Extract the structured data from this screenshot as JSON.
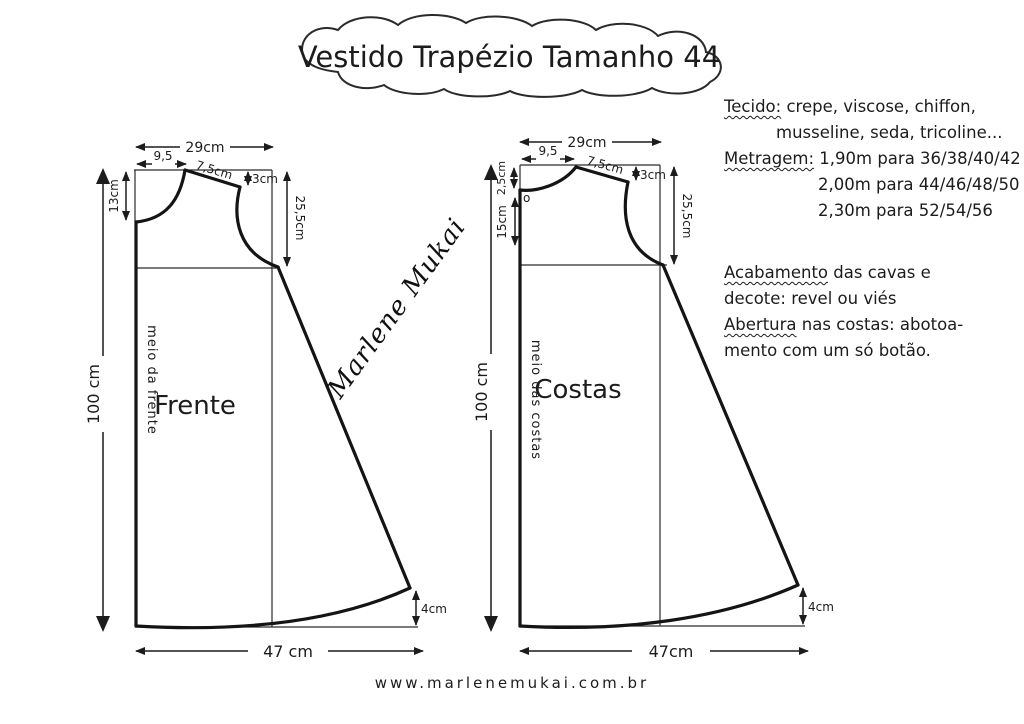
{
  "title": "Vestido Trapézio Tamanho 44",
  "notes": {
    "tecido_label": "Tecido:",
    "tecido_rest": "crepe, viscose, chiffon,",
    "tecido_line2": "musseline, seda, tricoline...",
    "metragem_label": "Metragem:",
    "metragem_row1": "1,90m para 36/38/40/42",
    "metragem_row2": "2,00m para 44/46/48/50",
    "metragem_row3": "2,30m para 52/54/56",
    "acabamento_label": "Acabamento",
    "acabamento_rest": "das cavas e",
    "acabamento_line2": "decote: revel ou viés",
    "abertura_label": "Abertura",
    "abertura_rest": "nas costas: abotoa-",
    "abertura_line2": "mento com um só botão."
  },
  "front": {
    "piece_label": "Frente",
    "center_line_label": "meio da frente",
    "top_width": "29cm",
    "neck_width": "9,5",
    "shoulder_length": "7,5cm",
    "shoulder_drop": "3cm",
    "neck_depth": "13cm",
    "armhole_depth": "25,5cm",
    "length": "100 cm",
    "hem_width": "47 cm",
    "hem_rise": "4cm"
  },
  "back": {
    "piece_label": "Costas",
    "center_line_label": "meio das costas",
    "top_width": "29cm",
    "neck_width": "9,5",
    "shoulder_length": "7,5cm",
    "shoulder_drop": "3cm",
    "neck_depth": "2,5cm",
    "opening_length": "15cm",
    "armhole_depth": "25,5cm",
    "length": "100 cm",
    "hem_width": "47cm",
    "hem_rise": "4cm",
    "button_mark": "o"
  },
  "signature": "Marlene Mukai",
  "footer_url": "www.marlenemukai.com.br",
  "ink_color": "#1c1c1c"
}
